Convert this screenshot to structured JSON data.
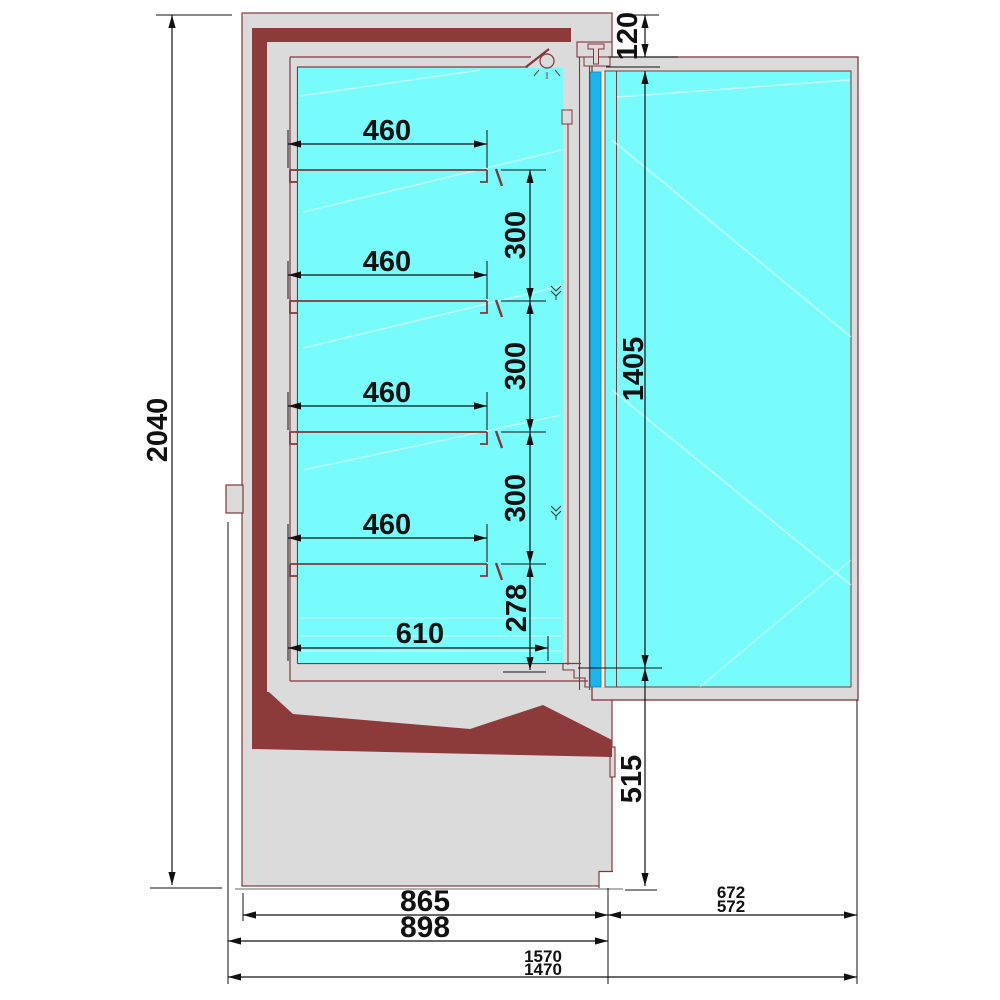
{
  "diagram": {
    "type": "technical-cross-section",
    "subject": "refrigerated display cabinet with glass door, side section view",
    "units": "mm",
    "colors": {
      "body_gray": "#dbdbdb",
      "insulation_maroon": "#8c3a3a",
      "line_maroon": "#83373a",
      "interior_cyan": "#78fbfb",
      "door_glass_blue": "#1ab4ee",
      "dimension_black": "#111111",
      "ground_gray": "#9a9a9a"
    },
    "dims": {
      "overall_height": "2040",
      "canopy_height": "120",
      "door_glass_height": "1405",
      "base_height": "515",
      "shelf_depths": [
        "460",
        "460",
        "460",
        "460"
      ],
      "shelf_gaps": [
        "300",
        "300",
        "300"
      ],
      "bottom_gap": "278",
      "bottom_shelf_depth": "610",
      "body_depth": "865",
      "overall_depth": "898",
      "door_width_a": "672",
      "door_width_b": "572",
      "open_total_depth_a": "1570",
      "open_total_depth_b": "1470"
    }
  }
}
